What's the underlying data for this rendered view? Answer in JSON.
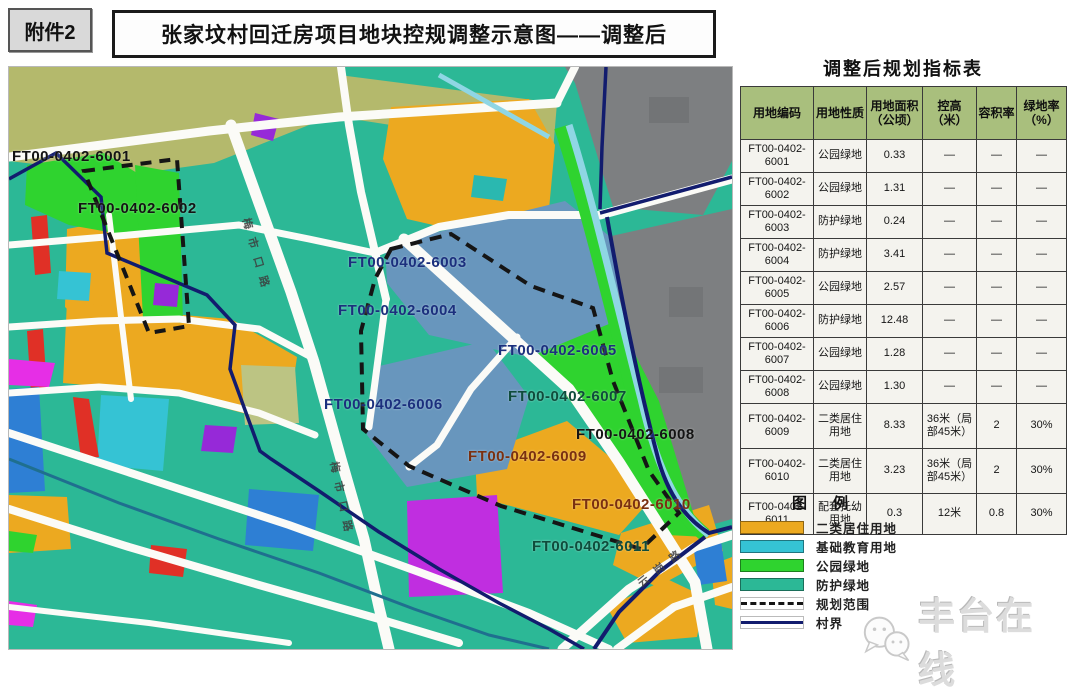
{
  "attachment_label": "附件2",
  "title": "张家坟村回迁房项目地块控规调整示意图——调整后",
  "table": {
    "title": "调整后规划指标表",
    "headers": [
      "用地编码",
      "用地性质",
      "用地面积（公顷）",
      "控高（米）",
      "容积率",
      "绿地率（%）"
    ],
    "rows": [
      {
        "code": "FT00-0402-6001",
        "use": "公园绿地",
        "area": "0.33",
        "height": "—",
        "far": "—",
        "green": "—"
      },
      {
        "code": "FT00-0402-6002",
        "use": "公园绿地",
        "area": "1.31",
        "height": "—",
        "far": "—",
        "green": "—"
      },
      {
        "code": "FT00-0402-6003",
        "use": "防护绿地",
        "area": "0.24",
        "height": "—",
        "far": "—",
        "green": "—"
      },
      {
        "code": "FT00-0402-6004",
        "use": "防护绿地",
        "area": "3.41",
        "height": "—",
        "far": "—",
        "green": "—"
      },
      {
        "code": "FT00-0402-6005",
        "use": "公园绿地",
        "area": "2.57",
        "height": "—",
        "far": "—",
        "green": "—"
      },
      {
        "code": "FT00-0402-6006",
        "use": "防护绿地",
        "area": "12.48",
        "height": "—",
        "far": "—",
        "green": "—"
      },
      {
        "code": "FT00-0402-6007",
        "use": "公园绿地",
        "area": "1.28",
        "height": "—",
        "far": "—",
        "green": "—"
      },
      {
        "code": "FT00-0402-6008",
        "use": "公园绿地",
        "area": "1.30",
        "height": "—",
        "far": "—",
        "green": "—"
      },
      {
        "code": "FT00-0402-6009",
        "use": "二类居住用地",
        "area": "8.33",
        "height": "36米（局部45米）",
        "far": "2",
        "green": "30%"
      },
      {
        "code": "FT00-0402-6010",
        "use": "二类居住用地",
        "area": "3.23",
        "height": "36米（局部45米）",
        "far": "2",
        "green": "30%"
      },
      {
        "code": "FT00-0402-6011",
        "use": "配套托幼用地",
        "area": "0.3",
        "height": "12米",
        "far": "0.8",
        "green": "30%"
      }
    ]
  },
  "legend": {
    "title": "图例",
    "items": [
      {
        "label": "二类居住用地",
        "type": "swatch",
        "color": "#eca920"
      },
      {
        "label": "基础教育用地",
        "type": "swatch",
        "color": "#35c3d4"
      },
      {
        "label": "公园绿地",
        "type": "swatch",
        "color": "#2fd32f"
      },
      {
        "label": "防护绿地",
        "type": "swatch",
        "color": "#2cb896"
      },
      {
        "label": "规划范围",
        "type": "dashed-line",
        "color": "#151515"
      },
      {
        "label": "村界",
        "type": "solid-line",
        "color": "#121c6e"
      }
    ]
  },
  "map": {
    "plot_labels": [
      {
        "text": "FT00-0402-6001",
        "x": 4,
        "y": 82,
        "color": "#141414"
      },
      {
        "text": "FT00-0402-6002",
        "x": 70,
        "y": 134,
        "color": "#141414"
      },
      {
        "text": "FT00-0402-6003",
        "x": 340,
        "y": 188,
        "color": "#1b2f7d"
      },
      {
        "text": "FT00-0402-6004",
        "x": 330,
        "y": 236,
        "color": "#1b2f7d"
      },
      {
        "text": "FT00-0402-6005",
        "x": 490,
        "y": 276,
        "color": "#1b2f7d"
      },
      {
        "text": "FT00-0402-6006",
        "x": 316,
        "y": 330,
        "color": "#1b2f7d"
      },
      {
        "text": "FT00-0402-6007",
        "x": 500,
        "y": 322,
        "color": "#0f4c3c"
      },
      {
        "text": "FT00-0402-6008",
        "x": 568,
        "y": 360,
        "color": "#141414"
      },
      {
        "text": "FT00-0402-6009",
        "x": 460,
        "y": 382,
        "color": "#7a3010"
      },
      {
        "text": "FT00-0402-6010",
        "x": 564,
        "y": 430,
        "color": "#7a3010"
      },
      {
        "text": "FT00-0402-6011",
        "x": 524,
        "y": 472,
        "color": "#0f4c3c"
      }
    ],
    "road_labels": [
      {
        "text": "梅市口路",
        "x": 246,
        "y": 150,
        "rotate": 74
      },
      {
        "text": "梅市口路",
        "x": 334,
        "y": 394,
        "rotate": 78
      },
      {
        "text": "云岗路",
        "x": 626,
        "y": 512,
        "rotate": -38
      }
    ]
  },
  "watermark": {
    "text": "丰台在线",
    "icon": "wechat-icon"
  }
}
